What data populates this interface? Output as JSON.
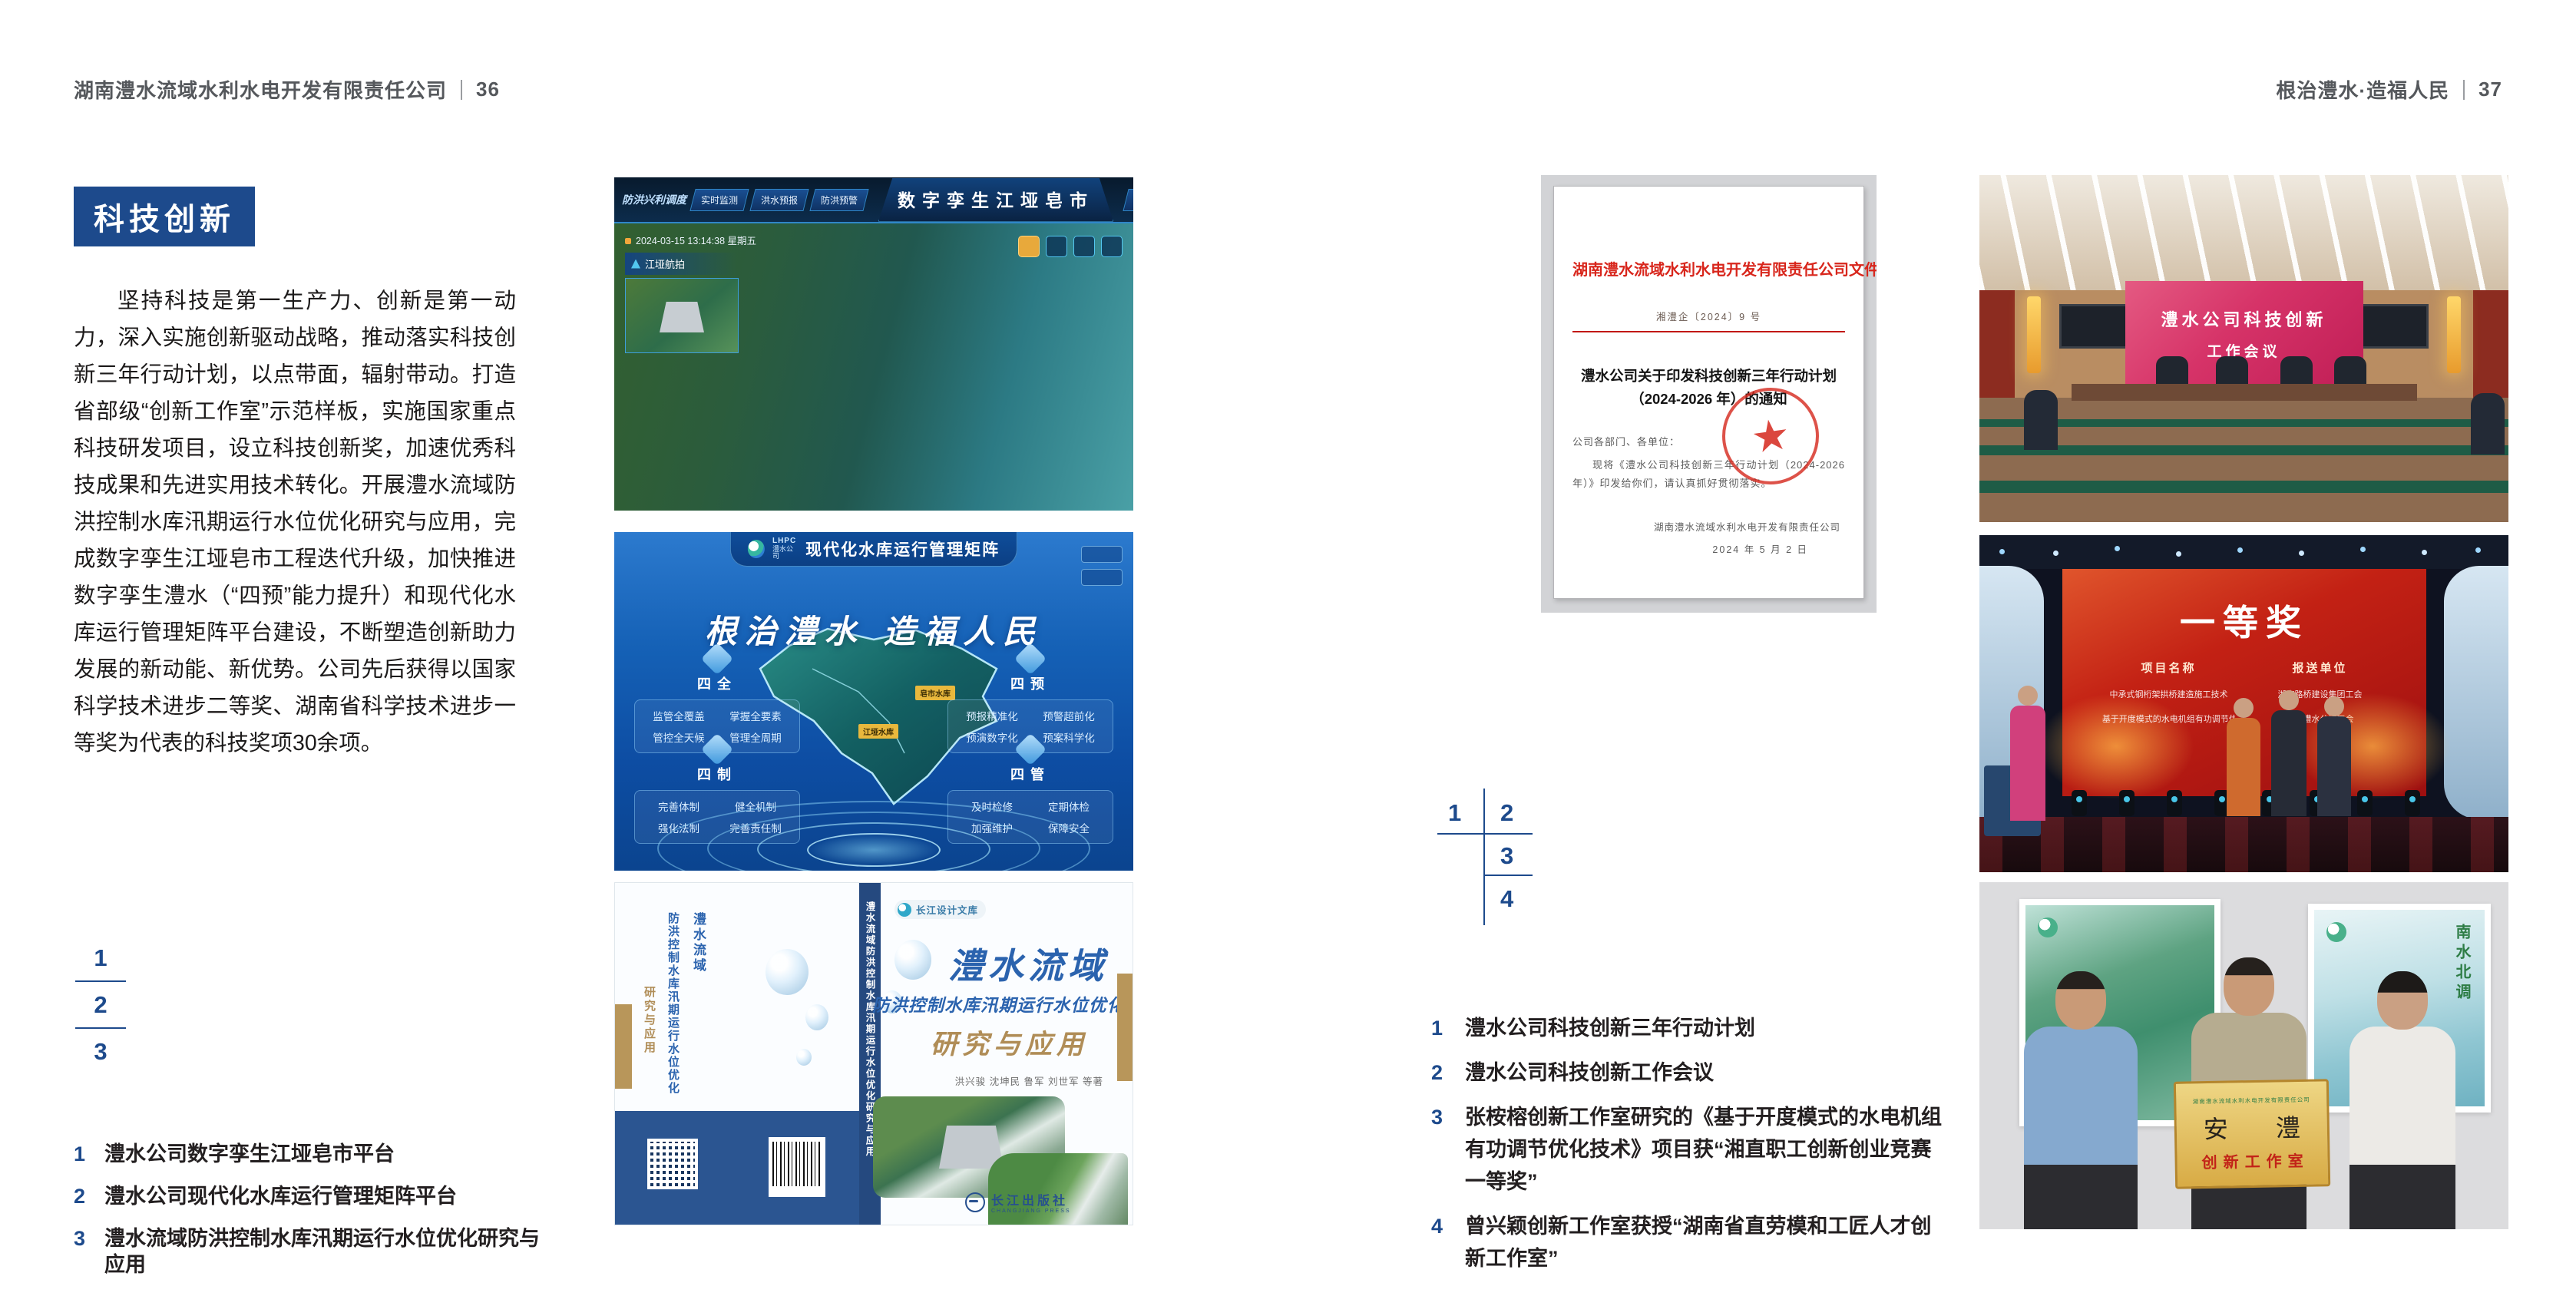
{
  "page_left": {
    "header": "湖南澧水流域水利水电开发有限责任公司",
    "page_number": "36",
    "section_badge": "科技创新",
    "body": "坚持科技是第一生产力、创新是第一动力，深入实施创新驱动战略，推动落实科技创新三年行动计划，以点带面，辐射带动。打造省部级“创新工作室”示范样板，实施国家重点科技研发项目，设立科技创新奖，加速优秀科技成果和先进实用技术转化。开展澧水流域防洪控制水库汛期运行水位优化研究与应用，完成数字孪生江垭皂市工程迭代升级，加快推进数字孪生澧水（“四预”能力提升）和现代化水库运行管理矩阵平台建设，不断塑造创新助力发展的新动能、新优势。公司先后获得以国家科学技术进步二等奖、湖南省科学技术进步一等奖为代表的科技奖项30余项。",
    "figure_index": [
      "1",
      "2",
      "3"
    ],
    "captions": [
      {
        "num": "1",
        "text": "澧水公司数字孪生江垭皂市平台"
      },
      {
        "num": "2",
        "text": "澧水公司现代化水库运行管理矩阵平台"
      },
      {
        "num": "3",
        "text": "澧水流域防洪控制水库汛期运行水位优化研究与应用"
      }
    ]
  },
  "page_right": {
    "header": "根治澧水·造福人民",
    "page_number": "37",
    "figure_index": [
      "1",
      "2",
      "3",
      "4"
    ],
    "captions": [
      {
        "num": "1",
        "text": "澧水公司科技创新三年行动计划"
      },
      {
        "num": "2",
        "text": "澧水公司科技创新工作会议"
      },
      {
        "num": "3",
        "text": "张桉榕创新工作室研究的《基于开度模式的水电机组有功调节优化技术》项目获“湘直职工创新创业竞赛一等奖”"
      },
      {
        "num": "4",
        "text": "曾兴颖创新工作室获授“湖南省直劳模和工匠人才创新工作室”"
      }
    ]
  },
  "figures": {
    "twin": {
      "title": "数字孪生江垭皂市",
      "menu_label": "防洪兴利调度",
      "tabs_left": [
        "实时监测",
        "洪水预报",
        "防洪预警"
      ],
      "tabs_right": [
        "风险预判",
        "预案生成",
        "调度执行",
        "工程导览"
      ],
      "timestamp": "2024-03-15 13:14:38 星期五",
      "panel_title": "江垭航拍"
    },
    "matrix": {
      "logo_abbr": "LHPC",
      "logo_text": "澧水公司",
      "title": "现代化水库运行管理矩阵",
      "slogan": "根治澧水 造福人民",
      "panels": [
        {
          "title": "四全",
          "items": [
            "监管全覆盖",
            "掌握全要素",
            "管控全天候",
            "管理全周期"
          ]
        },
        {
          "title": "四预",
          "items": [
            "预报精准化",
            "预警超前化",
            "预演数字化",
            "预案科学化"
          ]
        },
        {
          "title": "四制",
          "items": [
            "完善体制",
            "健全机制",
            "强化法制",
            "完善责任制"
          ]
        },
        {
          "title": "四管",
          "items": [
            "及时检修",
            "定期体检",
            "加强维护",
            "保障安全"
          ]
        }
      ],
      "map_labels": [
        "江垭水库",
        "皂市水库"
      ]
    },
    "book": {
      "series": "长江设计文库",
      "title_main": "澧水流域",
      "title_sub": "防洪控制水库汛期运行水位优化",
      "title_tail": "研究与应用",
      "authors": "洪兴骏  沈坤民  鲁军  刘世军  等著",
      "publisher": "长江出版社",
      "publisher_en": "CHANGJIANG PRESS",
      "spine_text": "澧水流域防洪控制水库汛期运行水位优化研究与应用"
    },
    "notice": {
      "header": "湖南澧水流域水利水电开发有限责任公司文件",
      "doc_number": "湘澧企〔2024〕9 号",
      "title_line1": "澧水公司关于印发科技创新三年行动计划",
      "title_line2": "（2024-2026 年）的通知",
      "salutation": "公司各部门、各单位：",
      "body": "现将《澧水公司科技创新三年行动计划（2024-2026 年）》印发给你们，请认真抓好贯彻落实。",
      "signature": "湖南澧水流域水利水电开发有限责任公司",
      "date": "2024 年 5 月 2 日"
    },
    "meeting": {
      "screen_line1": "澧水公司科技创新",
      "screen_line2": "工作会议"
    },
    "award": {
      "heading": "一等奖",
      "col_project": "项目名称",
      "col_unit": "报送单位",
      "rows": [
        {
          "project": "中承式钢桁架拱桥建造施工技术",
          "unit": "湖南路桥建设集团工会"
        },
        {
          "project": "基于开度模式的水电机组有功调节优化技术",
          "unit": "湖南澧水公司工会"
        }
      ]
    },
    "studio": {
      "plaque_org": "湖南澧水流域水利水电开发有限责任公司",
      "plaque_name": "安 澧",
      "plaque_title": "创新工作室",
      "poster_right_text": "南水北调"
    }
  }
}
